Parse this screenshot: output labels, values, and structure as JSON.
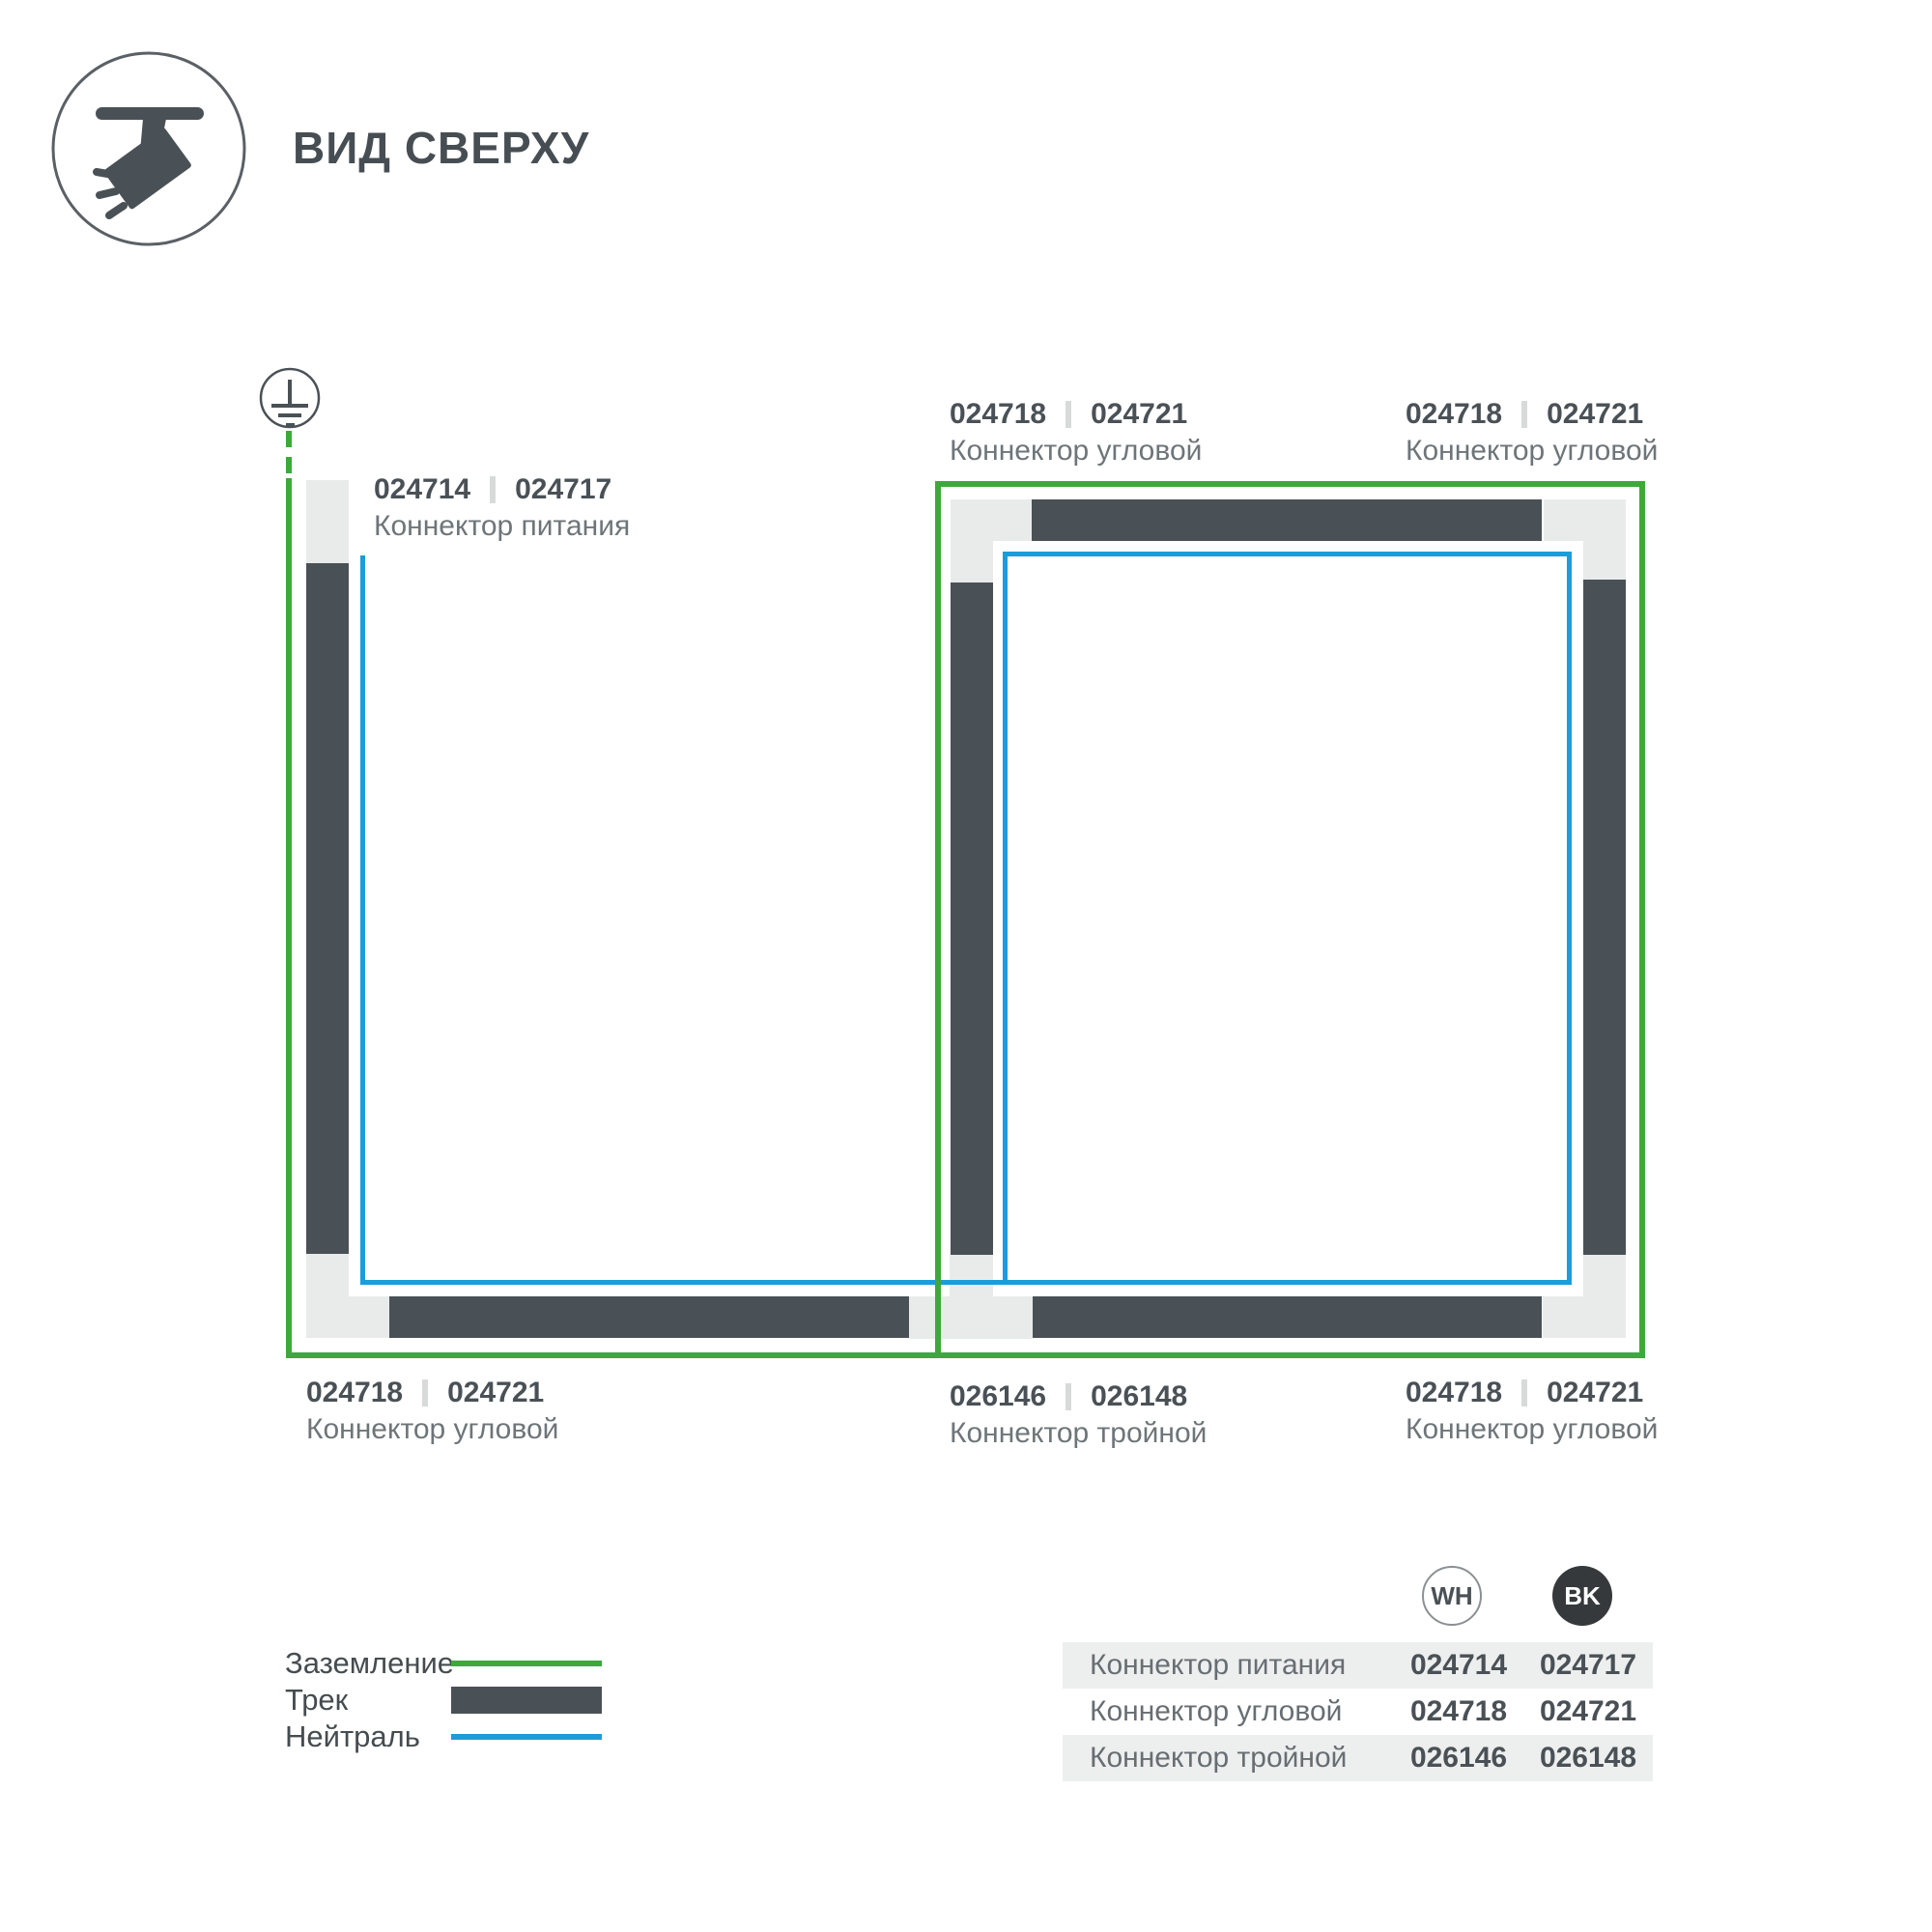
{
  "header": {
    "title": "ВИД СВЕРХУ"
  },
  "diagram": {
    "labels": {
      "power": {
        "code_wh": "024714",
        "code_bk": "024717",
        "name": "Коннектор питания"
      },
      "corner_top_mid": {
        "code_wh": "024718",
        "code_bk": "024721",
        "name": "Коннектор угловой"
      },
      "corner_top_right": {
        "code_wh": "024718",
        "code_bk": "024721",
        "name": "Коннектор угловой"
      },
      "corner_bottom_left": {
        "code_wh": "024718",
        "code_bk": "024721",
        "name": "Коннектор угловой"
      },
      "triple_bottom_mid": {
        "code_wh": "026146",
        "code_bk": "026148",
        "name": "Коннектор тройной"
      },
      "corner_bottom_right": {
        "code_wh": "024718",
        "code_bk": "024721",
        "name": "Коннектор угловой"
      }
    },
    "colors": {
      "ground_green": "#3EA83C",
      "track_dark": "#4A5156",
      "neutral_blue": "#1B9DD9",
      "connector_light": "#E9EBEB"
    }
  },
  "legend": {
    "ground_label": "Заземление",
    "track_label": "Трек",
    "neutral_label": "Нейтраль"
  },
  "table": {
    "badges": {
      "white": "WH",
      "black": "BK"
    },
    "rows": [
      {
        "name": "Коннектор питания",
        "wh": "024714",
        "bk": "024717"
      },
      {
        "name": "Коннектор угловой",
        "wh": "024718",
        "bk": "024721"
      },
      {
        "name": "Коннектор тройной",
        "wh": "026146",
        "bk": "026148"
      }
    ]
  }
}
